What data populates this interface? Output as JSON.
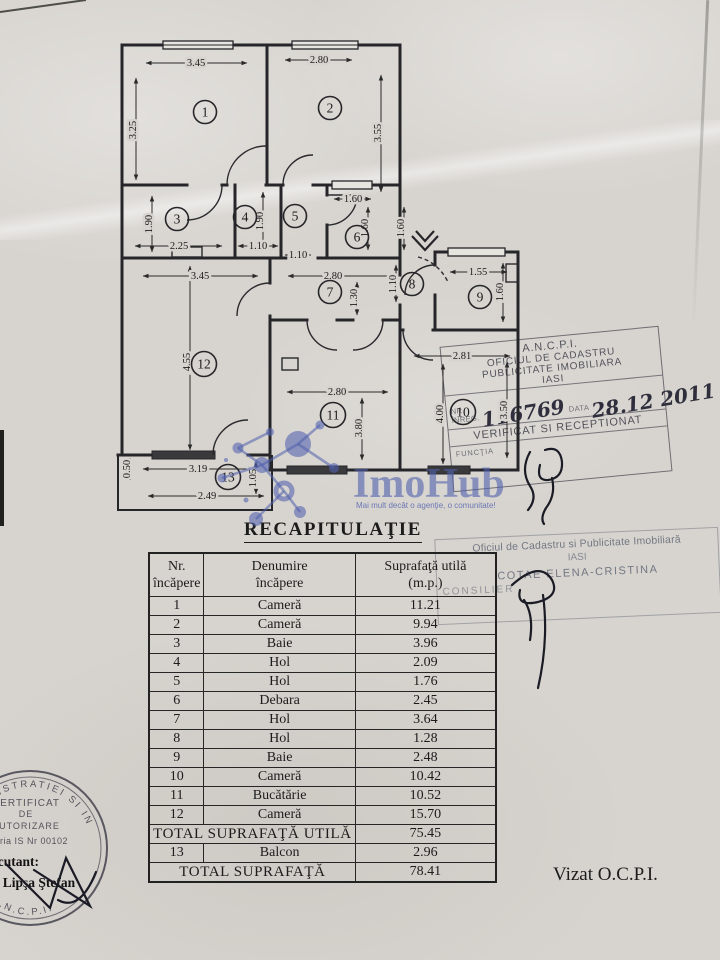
{
  "title": "RECAPITULAŢIE",
  "logo": {
    "name": "ImoHub",
    "tagline": "Mai mult decât o agenţie, o comunitate!"
  },
  "plan": {
    "rooms": [
      "1",
      "2",
      "3",
      "4",
      "5",
      "6",
      "7",
      "8",
      "9",
      "10",
      "11",
      "12",
      "13"
    ],
    "dims": {
      "d1": "3.45",
      "d2": "2.80",
      "d3": "3.25",
      "d4": "3.55",
      "d5": "1.90",
      "d6": "2.25",
      "d7": "1.10",
      "d8": "1.90",
      "d9": "1.10",
      "d10": "1.60",
      "d11": "1.60",
      "d12": "1.60",
      "d13": "3.45",
      "d14": "2.80",
      "d15": "1.30",
      "d16": "1.10",
      "d17": "1.55",
      "d18": "1.60",
      "d19": "2.81",
      "d20": "4.00",
      "d21": "3.50",
      "d22": "2.80",
      "d23": "3.80",
      "d24": "4.55",
      "d25": "3.19",
      "d26": "2.49",
      "d27": "0.50",
      "d28": "1.05"
    }
  },
  "table": {
    "headers": [
      {
        "l1": "Nr.",
        "l2": "încăpere"
      },
      {
        "l1": "Denumire",
        "l2": "încăpere"
      },
      {
        "l1": "Suprafaţă utilă",
        "l2": "(m.p.)"
      }
    ],
    "rows": [
      {
        "nr": "1",
        "name": "Cameră",
        "area": "11.21"
      },
      {
        "nr": "2",
        "name": "Cameră",
        "area": "9.94"
      },
      {
        "nr": "3",
        "name": "Baie",
        "area": "3.96"
      },
      {
        "nr": "4",
        "name": "Hol",
        "area": "2.09"
      },
      {
        "nr": "5",
        "name": "Hol",
        "area": "1.76"
      },
      {
        "nr": "6",
        "name": "Debara",
        "area": "2.45"
      },
      {
        "nr": "7",
        "name": "Hol",
        "area": "3.64"
      },
      {
        "nr": "8",
        "name": "Hol",
        "area": "1.28"
      },
      {
        "nr": "9",
        "name": "Baie",
        "area": "2.48"
      },
      {
        "nr": "10",
        "name": "Cameră",
        "area": "10.42"
      },
      {
        "nr": "11",
        "name": "Bucătărie",
        "area": "10.52"
      },
      {
        "nr": "12",
        "name": "Cameră",
        "area": "15.70"
      }
    ],
    "total_util": {
      "label": "TOTAL SUPRAFAŢĂ UTILĂ",
      "value": "75.45"
    },
    "balcon": {
      "nr": "13",
      "name": "Balcon",
      "area": "2.96"
    },
    "total": {
      "label": "TOTAL SUPRAFAŢĂ",
      "value": "78.41"
    }
  },
  "stamps": {
    "ancpi": {
      "l1": "A.N.C.P.I.",
      "l2": "OFICIUL DE CADASTRU",
      "l3": "PUBLICITATE IMOBILIARA",
      "l4": "IASI",
      "nr_label": "Nr. înreg.",
      "nr_value": "116769",
      "date_label": "data",
      "date_value": "28.12 2011",
      "verificat": "VERIFICAT SI RECEPTIONAT",
      "functie": "Funcţia"
    },
    "ocpi": {
      "l1": "Oficiul de Cadastru si Publicitate Imobiliară",
      "l2": "IASI",
      "l3": "COTAE ELENA-CRISTINA",
      "l4": "CONSILIER"
    },
    "round": {
      "arc_top": "ADMINISTRATIEI SI INTERNELOR",
      "l1": "CERTIFICAT",
      "l2": "DE",
      "l3": "AUTORIZARE",
      "l4": "Seria IS Nr 00102",
      "arc_bottom": "A.N.C.P.I.",
      "executant": "Executant:",
      "name": "ing. Lipşa Ştefan"
    }
  },
  "footer": {
    "vizat": "Vizat O.C.P.I."
  }
}
